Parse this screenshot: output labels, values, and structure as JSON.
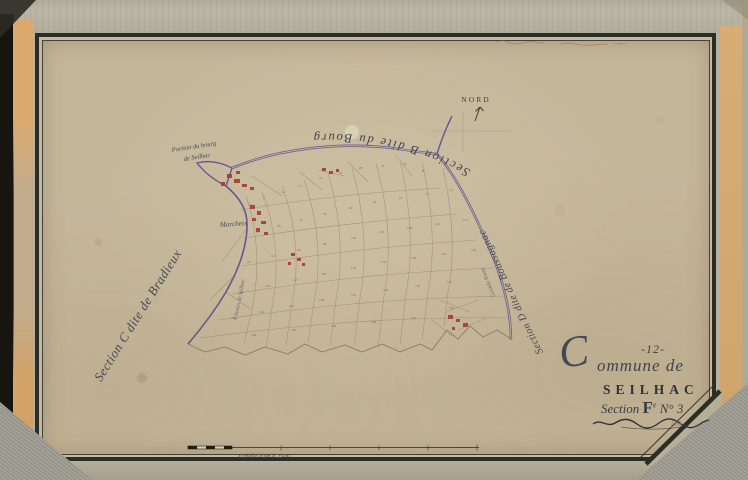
{
  "page": {
    "commune_number": "-12-",
    "commune_label_initial": "C",
    "commune_label_rest": "ommune de",
    "commune_name": "SEILHAC",
    "section_word": "Section",
    "section_letter": "F",
    "section_exponent": "e",
    "section_number": "N° 3",
    "pencil_note": "f.61"
  },
  "map": {
    "north_label": "NORD",
    "section_top_label": "Section B dite du Bourg",
    "section_left_label": "Section C dite de Bradieux",
    "section_right_label": "Section D dite de Boussagnac",
    "bourg_note": [
      "Portion du bourg",
      "de Seilhac"
    ],
    "village_label": "Marcheix",
    "road_label_left": "Chemin de Seilhac",
    "road_label_right": "Grande Route",
    "parcel_marks": [
      {
        "x": 249,
        "y": 206,
        "n": "12"
      },
      {
        "x": 263,
        "y": 199,
        "n": "9"
      },
      {
        "x": 281,
        "y": 193,
        "n": "14"
      },
      {
        "x": 299,
        "y": 187,
        "n": "17"
      },
      {
        "x": 319,
        "y": 179,
        "n": "21"
      },
      {
        "x": 339,
        "y": 174,
        "n": "25"
      },
      {
        "x": 359,
        "y": 169,
        "n": "28"
      },
      {
        "x": 381,
        "y": 167,
        "n": "31"
      },
      {
        "x": 403,
        "y": 165,
        "n": "35"
      },
      {
        "x": 421,
        "y": 172,
        "n": "38"
      },
      {
        "x": 256,
        "y": 233,
        "n": "47"
      },
      {
        "x": 277,
        "y": 227,
        "n": "45"
      },
      {
        "x": 299,
        "y": 221,
        "n": "52"
      },
      {
        "x": 323,
        "y": 215,
        "n": "56"
      },
      {
        "x": 349,
        "y": 209,
        "n": "60"
      },
      {
        "x": 373,
        "y": 203,
        "n": "64"
      },
      {
        "x": 399,
        "y": 199,
        "n": "67"
      },
      {
        "x": 425,
        "y": 195,
        "n": "70"
      },
      {
        "x": 449,
        "y": 191,
        "n": "73"
      },
      {
        "x": 247,
        "y": 263,
        "n": "90"
      },
      {
        "x": 271,
        "y": 257,
        "n": "92"
      },
      {
        "x": 297,
        "y": 251,
        "n": "96"
      },
      {
        "x": 323,
        "y": 245,
        "n": "99"
      },
      {
        "x": 351,
        "y": 239,
        "n": "102"
      },
      {
        "x": 379,
        "y": 233,
        "n": "105"
      },
      {
        "x": 407,
        "y": 229,
        "n": "108"
      },
      {
        "x": 435,
        "y": 225,
        "n": "112"
      },
      {
        "x": 463,
        "y": 221,
        "n": "115"
      },
      {
        "x": 239,
        "y": 293,
        "n": "121"
      },
      {
        "x": 265,
        "y": 287,
        "n": "124"
      },
      {
        "x": 293,
        "y": 281,
        "n": "127"
      },
      {
        "x": 321,
        "y": 275,
        "n": "130"
      },
      {
        "x": 351,
        "y": 269,
        "n": "133"
      },
      {
        "x": 381,
        "y": 263,
        "n": "136"
      },
      {
        "x": 411,
        "y": 259,
        "n": "139"
      },
      {
        "x": 441,
        "y": 255,
        "n": "142"
      },
      {
        "x": 471,
        "y": 251,
        "n": "145"
      },
      {
        "x": 231,
        "y": 319,
        "n": "150"
      },
      {
        "x": 259,
        "y": 313,
        "n": "152"
      },
      {
        "x": 289,
        "y": 307,
        "n": "155"
      },
      {
        "x": 319,
        "y": 301,
        "n": "158"
      },
      {
        "x": 351,
        "y": 296,
        "n": "161"
      },
      {
        "x": 383,
        "y": 291,
        "n": "164"
      },
      {
        "x": 415,
        "y": 287,
        "n": "167"
      },
      {
        "x": 447,
        "y": 283,
        "n": "170"
      },
      {
        "x": 251,
        "y": 336,
        "n": "180"
      },
      {
        "x": 291,
        "y": 331,
        "n": "183"
      },
      {
        "x": 331,
        "y": 327,
        "n": "186"
      },
      {
        "x": 371,
        "y": 323,
        "n": "189"
      },
      {
        "x": 411,
        "y": 319,
        "n": "192"
      },
      {
        "x": 449,
        "y": 309,
        "n": "195"
      }
    ]
  },
  "scale_bar": {
    "label": "Echelle d'un à 2500"
  },
  "colors": {
    "boundary_purple": "#655692",
    "building_red": "#a63f33",
    "paper": "#c7b99c",
    "ink": "#343a3e"
  }
}
